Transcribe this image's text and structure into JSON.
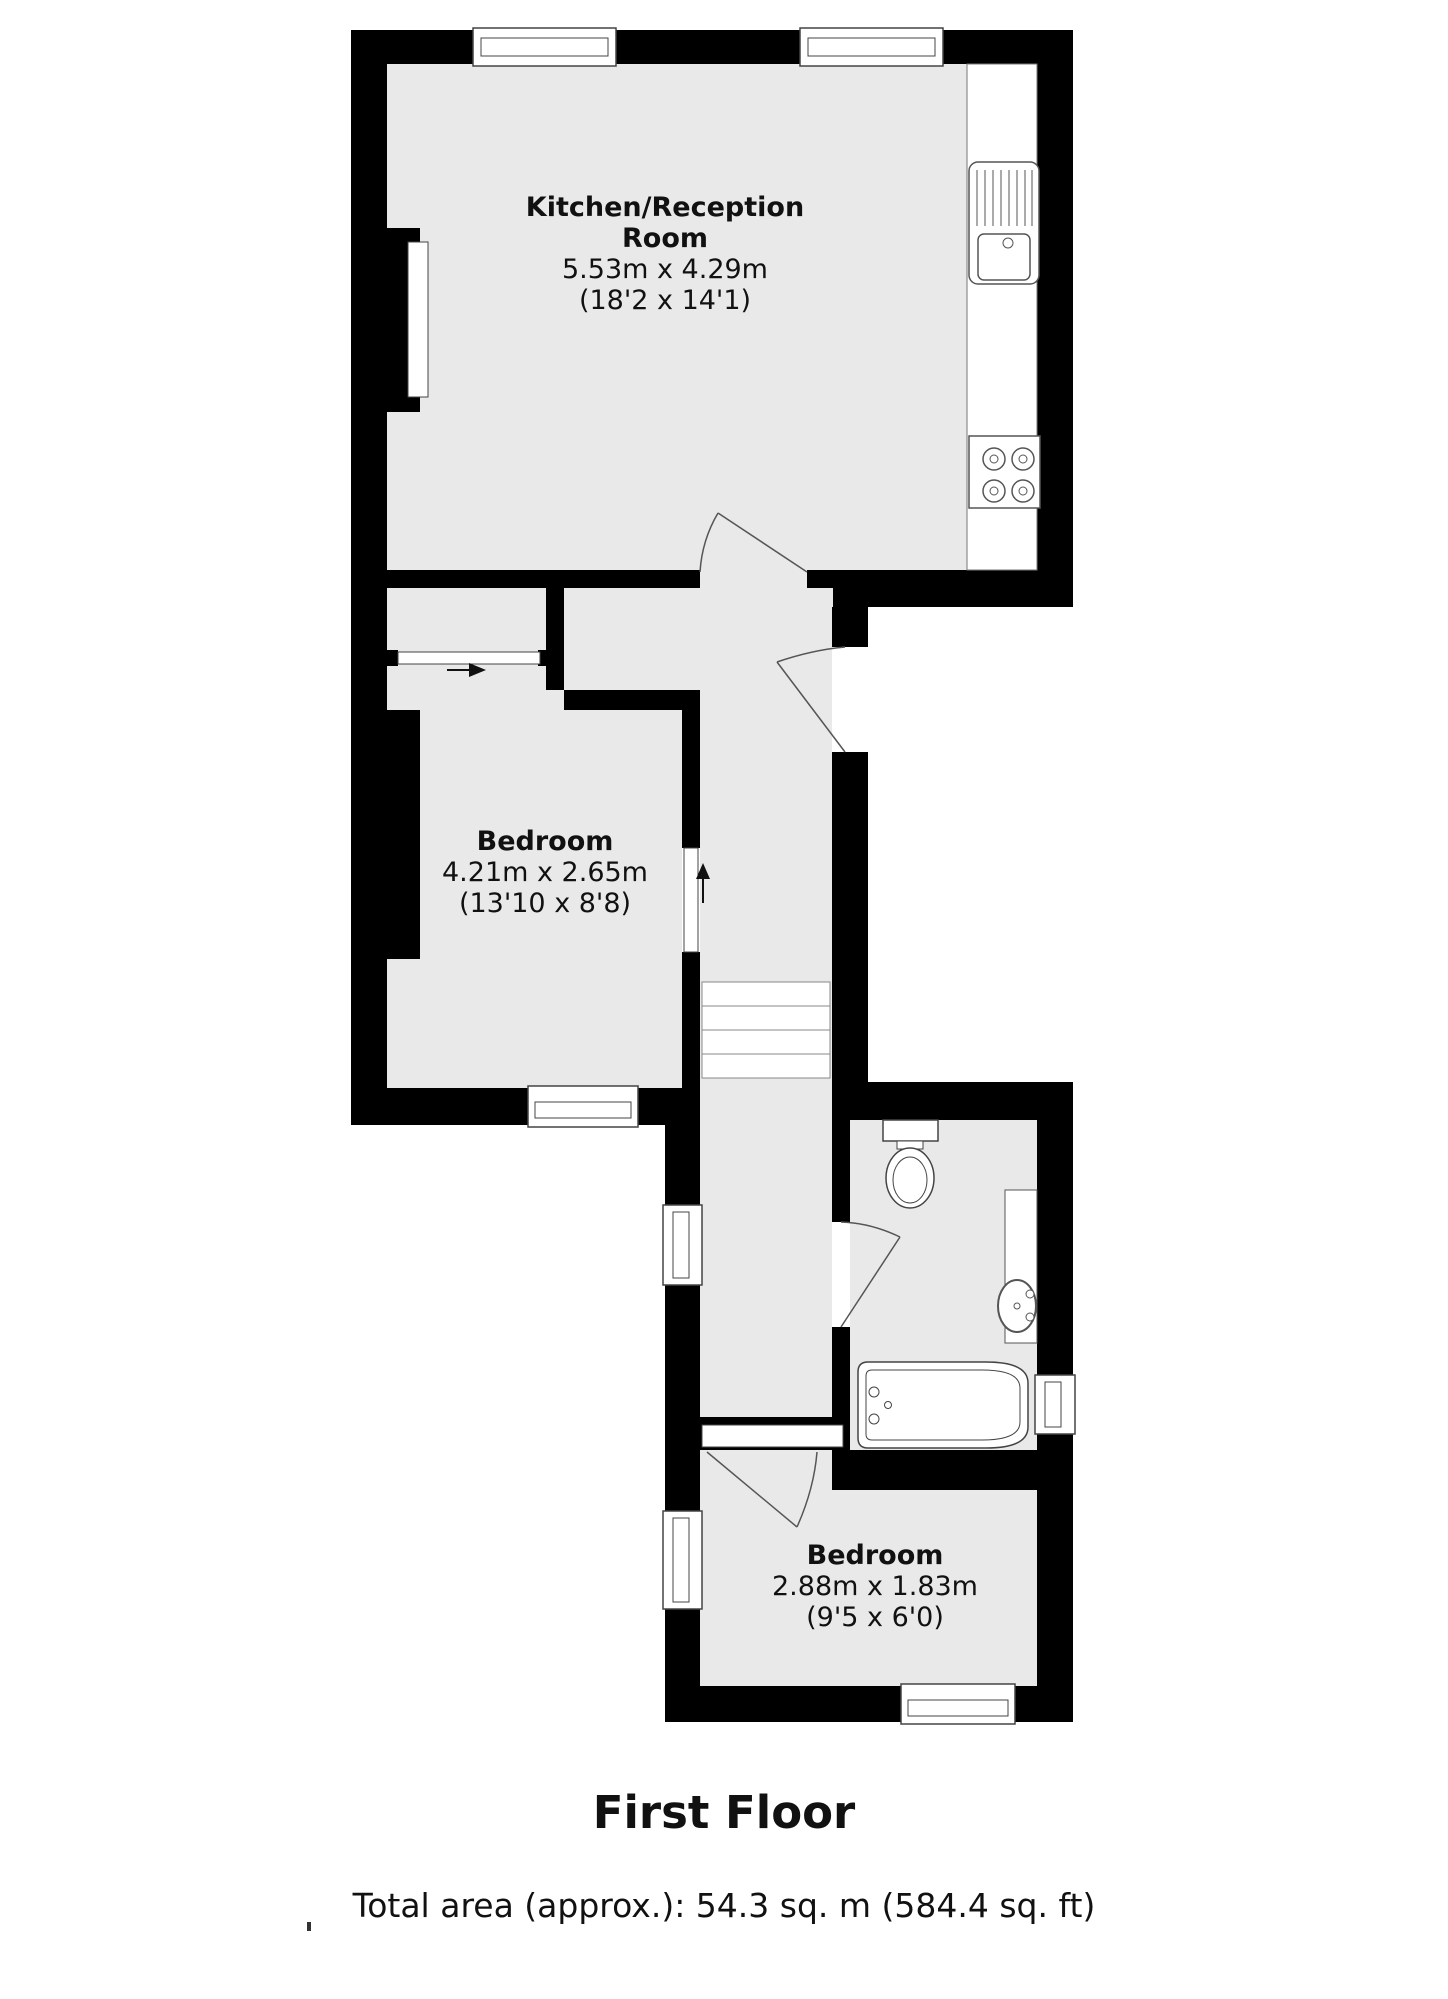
{
  "plan": {
    "rooms": [
      {
        "id": "kitchen-reception",
        "line1": "Kitchen/Reception",
        "line2": "Room",
        "dimensions_metric": "5.53m x 4.29m",
        "dimensions_imperial": "(18'2 x 14'1)"
      },
      {
        "id": "bedroom-1",
        "name": "Bedroom",
        "dimensions_metric": "4.21m x 2.65m",
        "dimensions_imperial": "(13'10 x 8'8)"
      },
      {
        "id": "bedroom-2",
        "name": "Bedroom",
        "dimensions_metric": "2.88m x 1.83m",
        "dimensions_imperial": "(9'5 x 6'0)"
      }
    ],
    "fixtures": [
      "kitchen-counter",
      "kitchen-sink",
      "hob",
      "staircase",
      "toilet",
      "wash-basin",
      "bathtub"
    ],
    "icons": [
      "right-arrow-icon",
      "up-arrow-icon"
    ],
    "footer": {
      "floor_title": "First Floor",
      "total_area": "Total area (approx.): 54.3 sq. m (584.4 sq. ft)"
    },
    "colors": {
      "wall": "#000000",
      "floor": "#e9e9e9",
      "fixture_outline": "#555555",
      "background": "#ffffff"
    }
  }
}
